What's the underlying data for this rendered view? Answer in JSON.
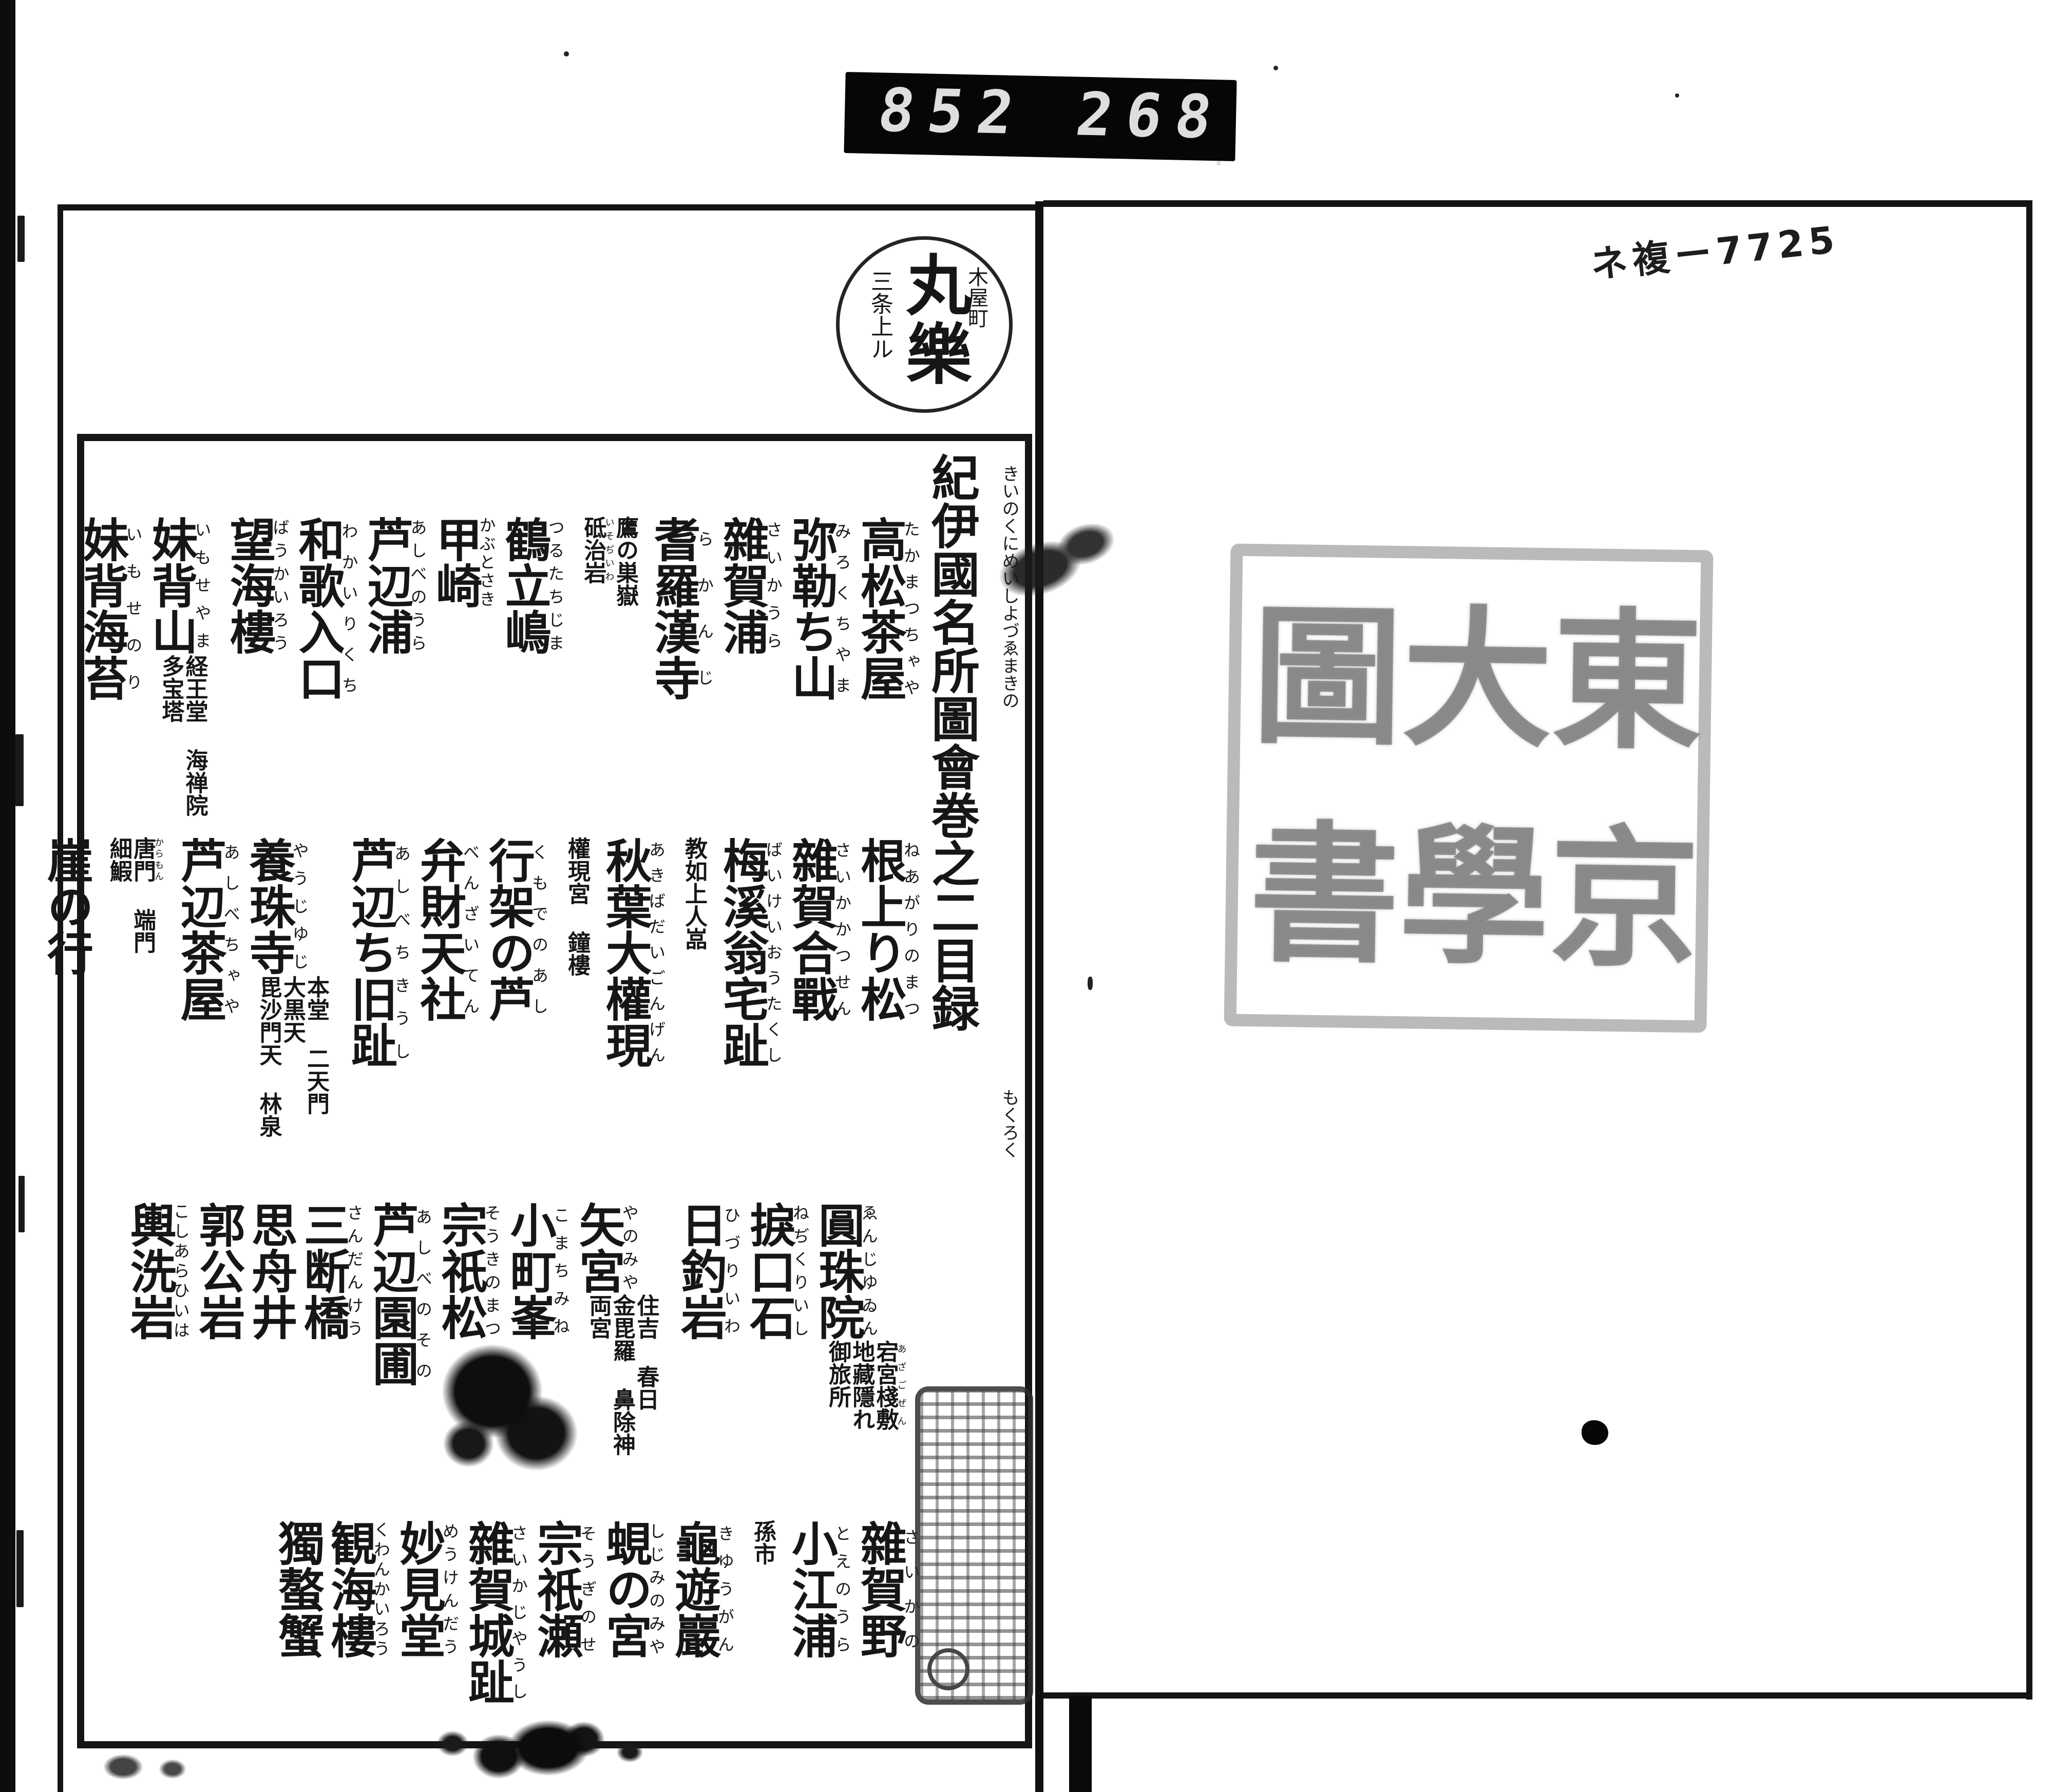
{
  "counter": {
    "left_digits": "852",
    "right_digits": "268",
    "decimal": "."
  },
  "call_number_note": "ネ複ー7725",
  "bookseller_stamp": {
    "center": "丸樂",
    "right": "木屋町",
    "left": "三条上ル"
  },
  "title_block": {
    "title": "紀伊國名所圖會巻之二目録",
    "kana_upper": "きいのくにめいしよづゑまきの",
    "kana_lower": "もくろく"
  },
  "toc": {
    "bands": [
      {
        "entries": [
          {
            "text": "高松茶屋",
            "kana": "たかまつちゃや"
          },
          {
            "text": "弥勒ち山",
            "kana": "みろくちやま"
          },
          {
            "text": "雜賀浦",
            "kana": "さいかうら"
          },
          {
            "text": "耆羅漢寺",
            "kana": "らかんじ",
            "subs": [
              {
                "text": "鷹の巣嶽"
              },
              {
                "text": "砥治岩",
                "kana": "いそぢいわ"
              }
            ]
          },
          {
            "text": "鶴立嶋",
            "kana": "つるたちじま"
          },
          {
            "text": "甲崎",
            "kana": "かぶとさき"
          },
          {
            "text": "芦辺浦",
            "kana": "あしべのうら"
          },
          {
            "text": "和歌入口",
            "kana": "わかいりくち"
          },
          {
            "text": "望海樓",
            "kana": "ばうかいろう"
          },
          {
            "text": "妹背山",
            "kana": "いもせやま",
            "subs": [
              {
                "text": "経王堂"
              },
              {
                "text": "海禅院"
              },
              {
                "text": "多宝塔"
              }
            ]
          },
          {
            "text": "妹背海苔",
            "kana": "いもせのり"
          }
        ]
      },
      {
        "entries": [
          {
            "text": "根上り松",
            "kana": "ねあがりのまつ"
          },
          {
            "text": "雜賀合戰",
            "kana": "さいかかつせん"
          },
          {
            "text": "梅溪翁宅趾",
            "kana": "ばいけいおうたくし",
            "subs": [
              {
                "text": "教如上人嵓"
              }
            ]
          },
          {
            "text": "秋葉大權現",
            "kana": "あきばだいごんげん",
            "subs": [
              {
                "text": "權現宮"
              },
              {
                "text": "鐘樓"
              }
            ]
          },
          {
            "text": "行架の芦",
            "kana": "くもでのあし"
          },
          {
            "text": "弁財天社",
            "kana": "べんざいてん"
          },
          {
            "text": "芦辺ち旧趾",
            "kana": "あしべちきうし"
          },
          {
            "text": "養珠寺",
            "kana": "やうじゆじ",
            "subs": [
              {
                "text": "本堂"
              },
              {
                "text": "二天門"
              },
              {
                "text": "大黒天"
              },
              {
                "text": "毘沙門天"
              },
              {
                "text": "林泉"
              }
            ]
          },
          {
            "text": "芦辺茶屋",
            "kana": "あしべちゃや",
            "subs": [
              {
                "text": "唐門",
                "kana": "からもん"
              },
              {
                "text": "端門"
              },
              {
                "text": "細鰕"
              }
            ]
          },
          {
            "text": "崖の行"
          }
        ]
      },
      {
        "entries": [
          {
            "text": "圓珠院",
            "kana": "ゑんじゆゐん",
            "subs": [
              {
                "text": "宕宮棧敷",
                "kana": "あざごぜん"
              },
              {
                "text": "地藏隱れ"
              },
              {
                "text": "御旅所"
              }
            ]
          },
          {
            "text": "捩口石",
            "kana": "ねぢくりいし"
          },
          {
            "text": "日釣岩",
            "kana": "ひづりいわ"
          },
          {
            "text": "矢宮",
            "kana": "やのみや",
            "subs": [
              {
                "text": "住吉"
              },
              {
                "text": "春日"
              },
              {
                "text": "金毘羅"
              },
              {
                "text": "鼻除神"
              },
              {
                "text": "両宮"
              }
            ]
          },
          {
            "text": "小町峯",
            "kana": "こまちみね"
          },
          {
            "text": "宗祇松",
            "kana": "そうきのまつ"
          },
          {
            "text": "芦辺園圃",
            "kana": "あしべのその"
          },
          {
            "text": "三断橋",
            "kana": "さんだんけう"
          },
          {
            "text": "思舟井"
          },
          {
            "text": "郭公岩"
          },
          {
            "text": "輿洗岩",
            "kana": "こしあらひいは"
          }
        ]
      },
      {
        "entries": [
          {
            "text": "雜賀野",
            "kana": "さいかの"
          },
          {
            "text": "小江浦",
            "kana": "とえのうら",
            "subs": [
              {
                "text": "孫市"
              }
            ]
          },
          {
            "text": "龜遊巖",
            "kana": "きゆうがん"
          },
          {
            "text": "蜆の宮",
            "kana": "しじみのみや"
          },
          {
            "text": "宗祇瀬",
            "kana": "そうぎのせ"
          },
          {
            "text": "雜賀城趾",
            "kana": "さいかじやうし"
          },
          {
            "text": "妙見堂",
            "kana": "めうけんだう"
          },
          {
            "text": "観海樓",
            "kana": "くわんかいろう"
          },
          {
            "text": "獨螯蟹"
          }
        ]
      }
    ]
  },
  "library_seal_large": {
    "columns_right_to_left": [
      [
        "東",
        "京"
      ],
      [
        "大",
        "學"
      ],
      [
        "圖",
        "書"
      ]
    ],
    "legible": false
  },
  "small_collection_seal": {
    "legible": false
  },
  "colors": {
    "ink": "#161616",
    "counter_background": "#060606",
    "counter_digits": "#dedede",
    "seal_faint_gray": "#8b8b8b",
    "page": "#ffffff"
  }
}
